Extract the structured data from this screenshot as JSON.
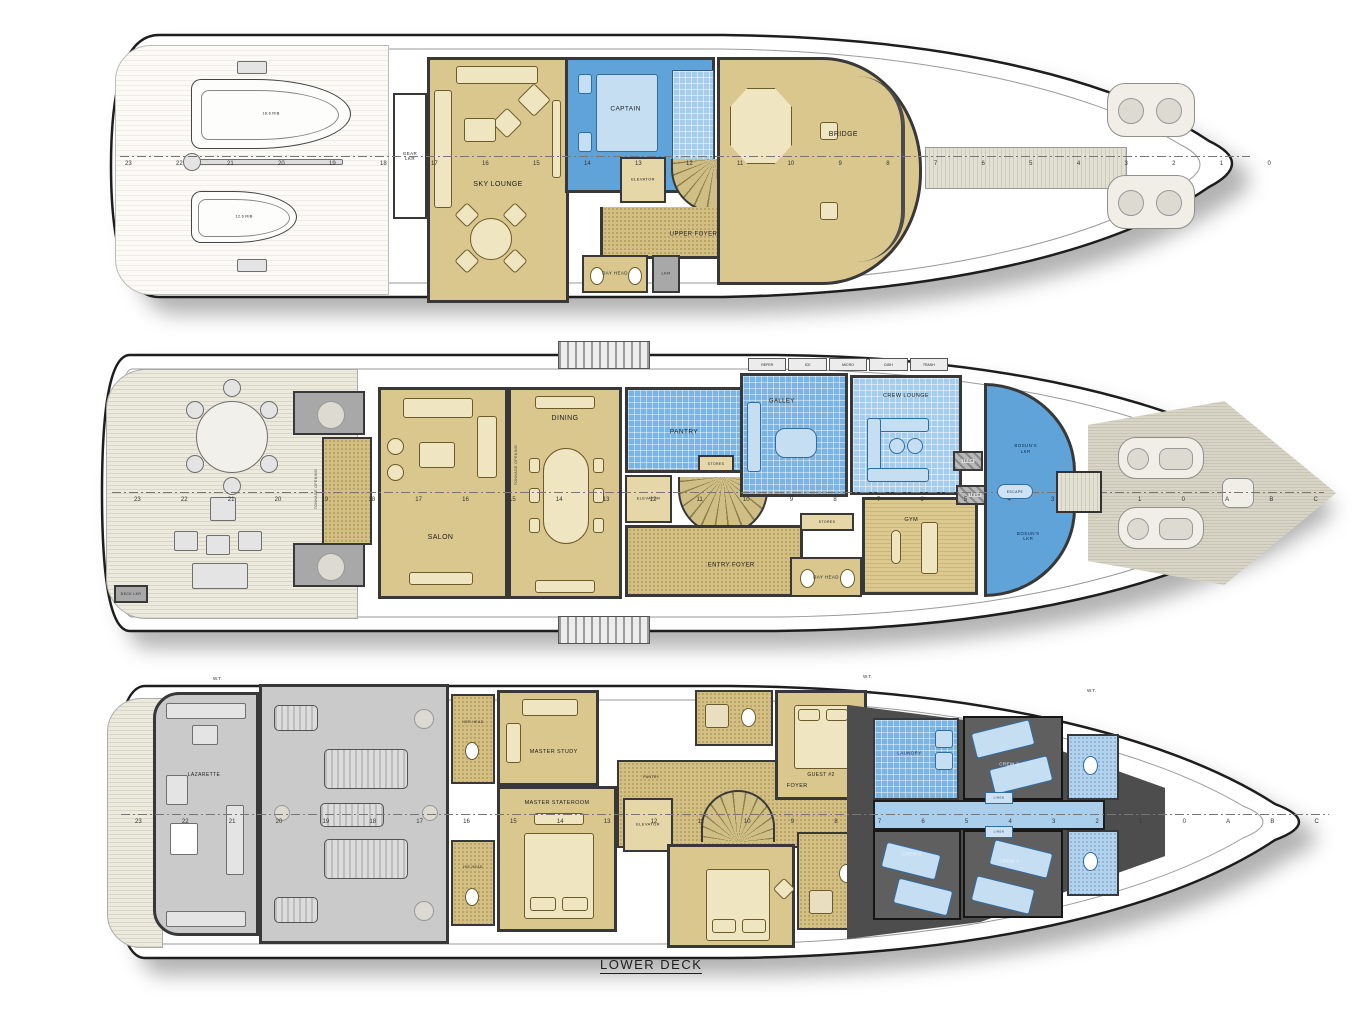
{
  "page": {
    "footer_title": "LOWER DECK"
  },
  "decks": {
    "upper": {
      "rooms": {
        "gear_lkr": "GEAR LKR",
        "sky_lounge": "SKY LOUNGE",
        "captain": "CAPTAIN",
        "elevator": "ELEVATOR",
        "upper_foyer": "UPPER FOYER",
        "day_head": "DAY HEAD",
        "lkr": "LKR",
        "bridge": "BRIDGE",
        "tender_large": "16.6 RIB",
        "tender_small": "12.6 RIB"
      },
      "stations": [
        "23",
        "22",
        "21",
        "20",
        "19",
        "18",
        "17",
        "16",
        "15",
        "14",
        "13",
        "12",
        "11",
        "10",
        "9",
        "8",
        "7",
        "6",
        "5",
        "4",
        "3",
        "2",
        "1",
        "0"
      ]
    },
    "main": {
      "rooms": {
        "salon": "SALON",
        "dining": "DINING",
        "pantry": "PANTRY",
        "elevator": "ELEVATOR",
        "entry_foyer": "ENTRY FOYER",
        "day_head": "DAY HEAD",
        "galley": "GALLEY",
        "crew_lounge": "CREW LOUNGE",
        "gym": "GYM",
        "tech": "TECH",
        "stores": "STORES",
        "bosuns_lkr": "BOSUN'S LKR",
        "escape": "ESCAPE",
        "deck_lkr": "DECK LKR"
      },
      "tonnage_opening": "TONNAGE OPENING",
      "appliances": [
        "REFER",
        "ICE",
        "MICRO",
        "DISH",
        "TRASH"
      ],
      "stations": [
        "23",
        "22",
        "21",
        "20",
        "19",
        "18",
        "17",
        "16",
        "15",
        "14",
        "13",
        "12",
        "11",
        "10",
        "9",
        "8",
        "7",
        "6",
        "5",
        "4",
        "3",
        "2",
        "1",
        "0",
        "A",
        "B",
        "C"
      ]
    },
    "lower": {
      "rooms": {
        "lazarette": "LAZARETTE",
        "master_study": "MASTER STUDY",
        "master_stateroom": "MASTER STATEROOM",
        "her_head": "HER HEAD",
        "his_head": "HIS HEAD",
        "pantry": "PANTRY",
        "elevator": "ELEVATOR",
        "foyer": "FOYER",
        "guest2": "GUEST #2",
        "laundry": "LAUNDRY",
        "crew1": "CREW 1",
        "crew2": "CREW 2",
        "crew3": "CREW 3",
        "linen": "LINEN"
      },
      "wt_label": "W.T.",
      "stations": [
        "23",
        "22",
        "21",
        "20",
        "19",
        "18",
        "17",
        "16",
        "15",
        "14",
        "13",
        "12",
        "11",
        "10",
        "9",
        "8",
        "7",
        "6",
        "5",
        "4",
        "3",
        "2",
        "1",
        "0",
        "A",
        "B",
        "C"
      ]
    }
  },
  "colors": {
    "tan": "#d9c78e",
    "crew_blue": "#5fa3d8",
    "tile_blue": "#79b4e3",
    "engine_gray": "#cacaca",
    "wall": "#383838"
  }
}
